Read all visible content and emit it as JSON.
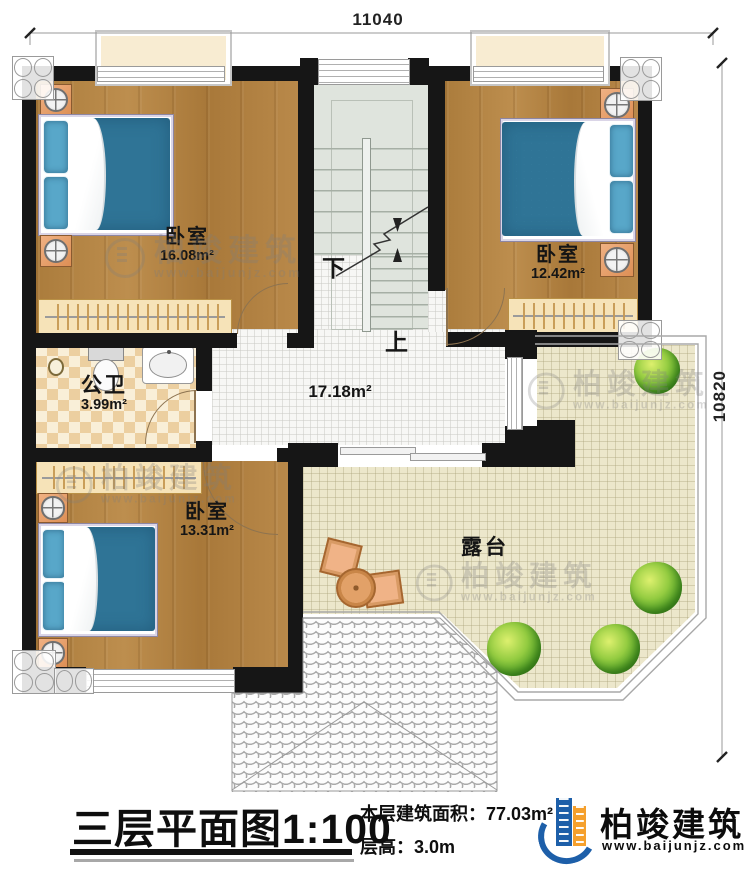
{
  "dimensions": {
    "width_top": "11040",
    "height_right": "10820"
  },
  "rooms": {
    "bedroom_top_left": {
      "name": "卧室",
      "area": "16.08m²"
    },
    "bedroom_top_right": {
      "name": "卧室",
      "area": "12.42m²"
    },
    "bedroom_bottom_left": {
      "name": "卧室",
      "area": "13.31m²"
    },
    "bathroom": {
      "name": "公卫",
      "area": "3.99m²"
    },
    "hall": {
      "area": "17.18m²"
    },
    "terrace": {
      "name": "露台"
    }
  },
  "stairs": {
    "down_label": "下",
    "up_label": "上"
  },
  "watermark": {
    "brand": "柏竣建筑",
    "url": "www.baijunjz.com"
  },
  "footer": {
    "title": "三层平面图",
    "scale": "1:100",
    "area_label": "本层建筑面积：",
    "area_value": "77.03m²",
    "floor_height_label": "层高：",
    "floor_height_value": "3.0m",
    "brand": "柏竣建筑",
    "brand_url": "www.baijunjz.com"
  },
  "colors": {
    "wall": "#161616",
    "wood_floor": "#b0813f",
    "mattress_blue": "#67b2d3",
    "terrace_floor": "#ece7cb",
    "bath_tile": "#eccfa0",
    "stair_floor": "#dfe4dd",
    "logo_blue": "#1d5fa9",
    "logo_orange": "#f5a02d"
  }
}
